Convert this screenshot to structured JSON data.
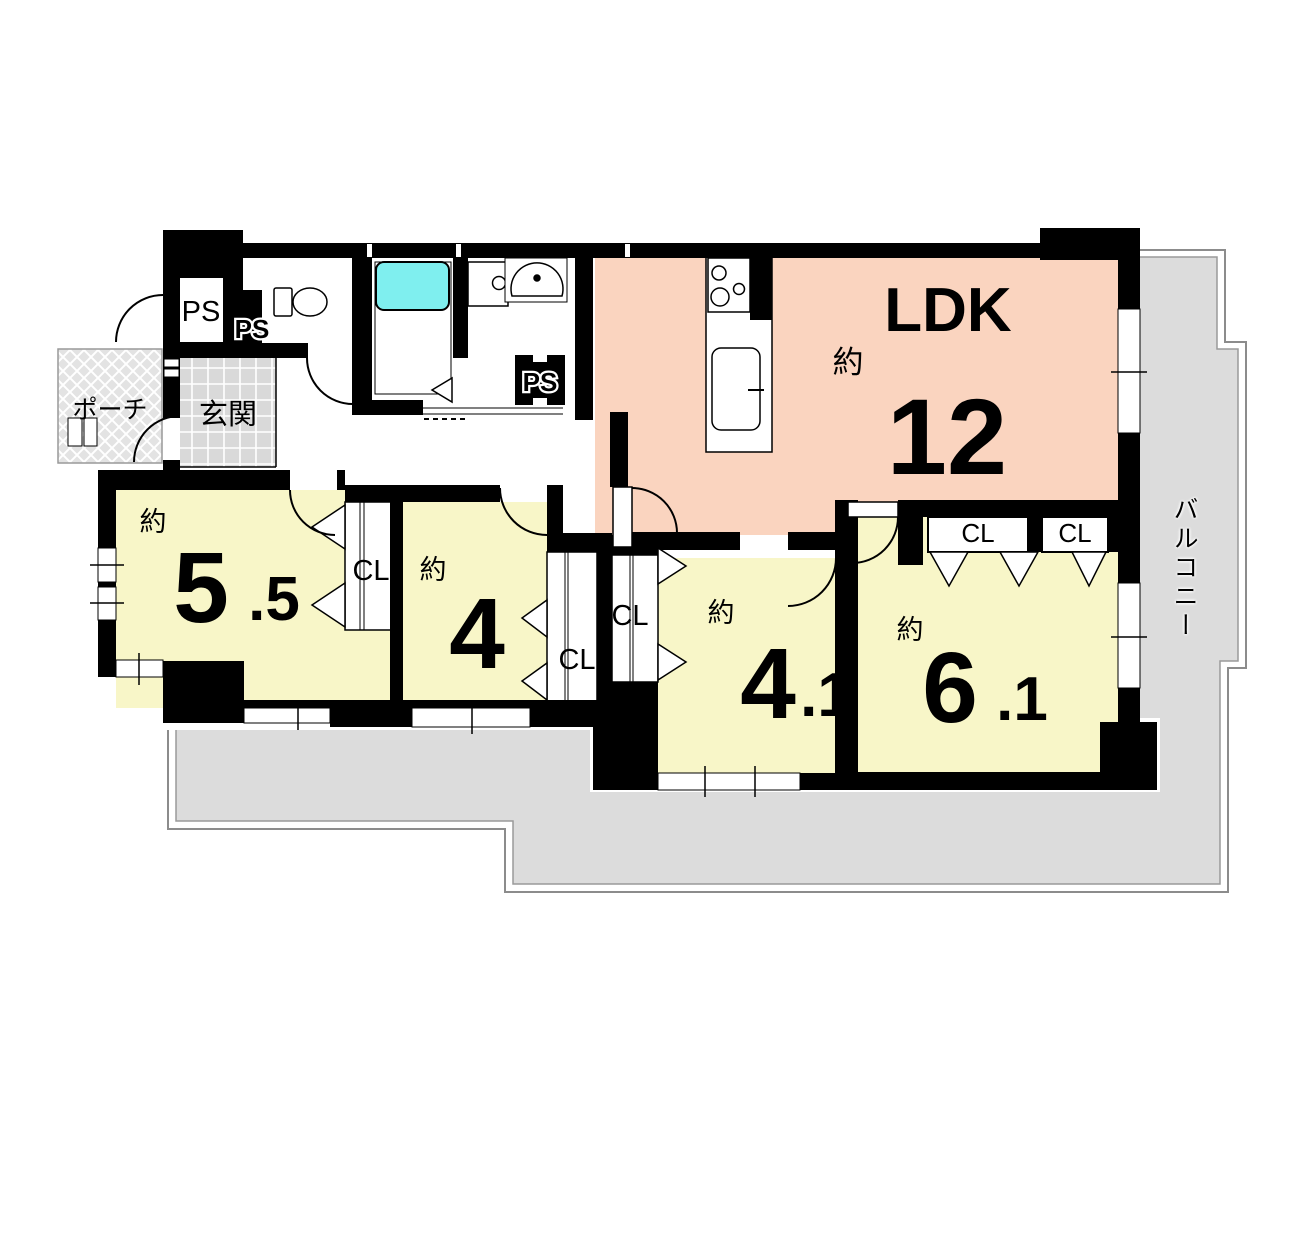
{
  "plan": {
    "balcony_label": "バルコニー",
    "porch_label": "ポーチ",
    "entrance_label": "玄関",
    "closet_label": "CL",
    "ps_labels": [
      "PS",
      "PS",
      "PS"
    ],
    "rooms": {
      "ldk": {
        "name": "LDK",
        "approx": "約",
        "size": "12"
      },
      "r55": {
        "approx": "約",
        "size_main": "5",
        "size_frac": ".5"
      },
      "r4": {
        "approx": "約",
        "size_main": "4",
        "size_frac": ""
      },
      "r41": {
        "approx": "約",
        "size_main": "4",
        "size_frac": ".1"
      },
      "r61": {
        "approx": "約",
        "size_main": "6",
        "size_frac": ".1"
      }
    },
    "colors": {
      "ldk": "#FAD4BF",
      "bedroom": "#F8F6C8",
      "balcony": "#DCDCDC",
      "tub": "#7FEFEF",
      "wall": "#000000",
      "tile": "#D9D9D9",
      "porch": "#E3E3E3"
    }
  }
}
